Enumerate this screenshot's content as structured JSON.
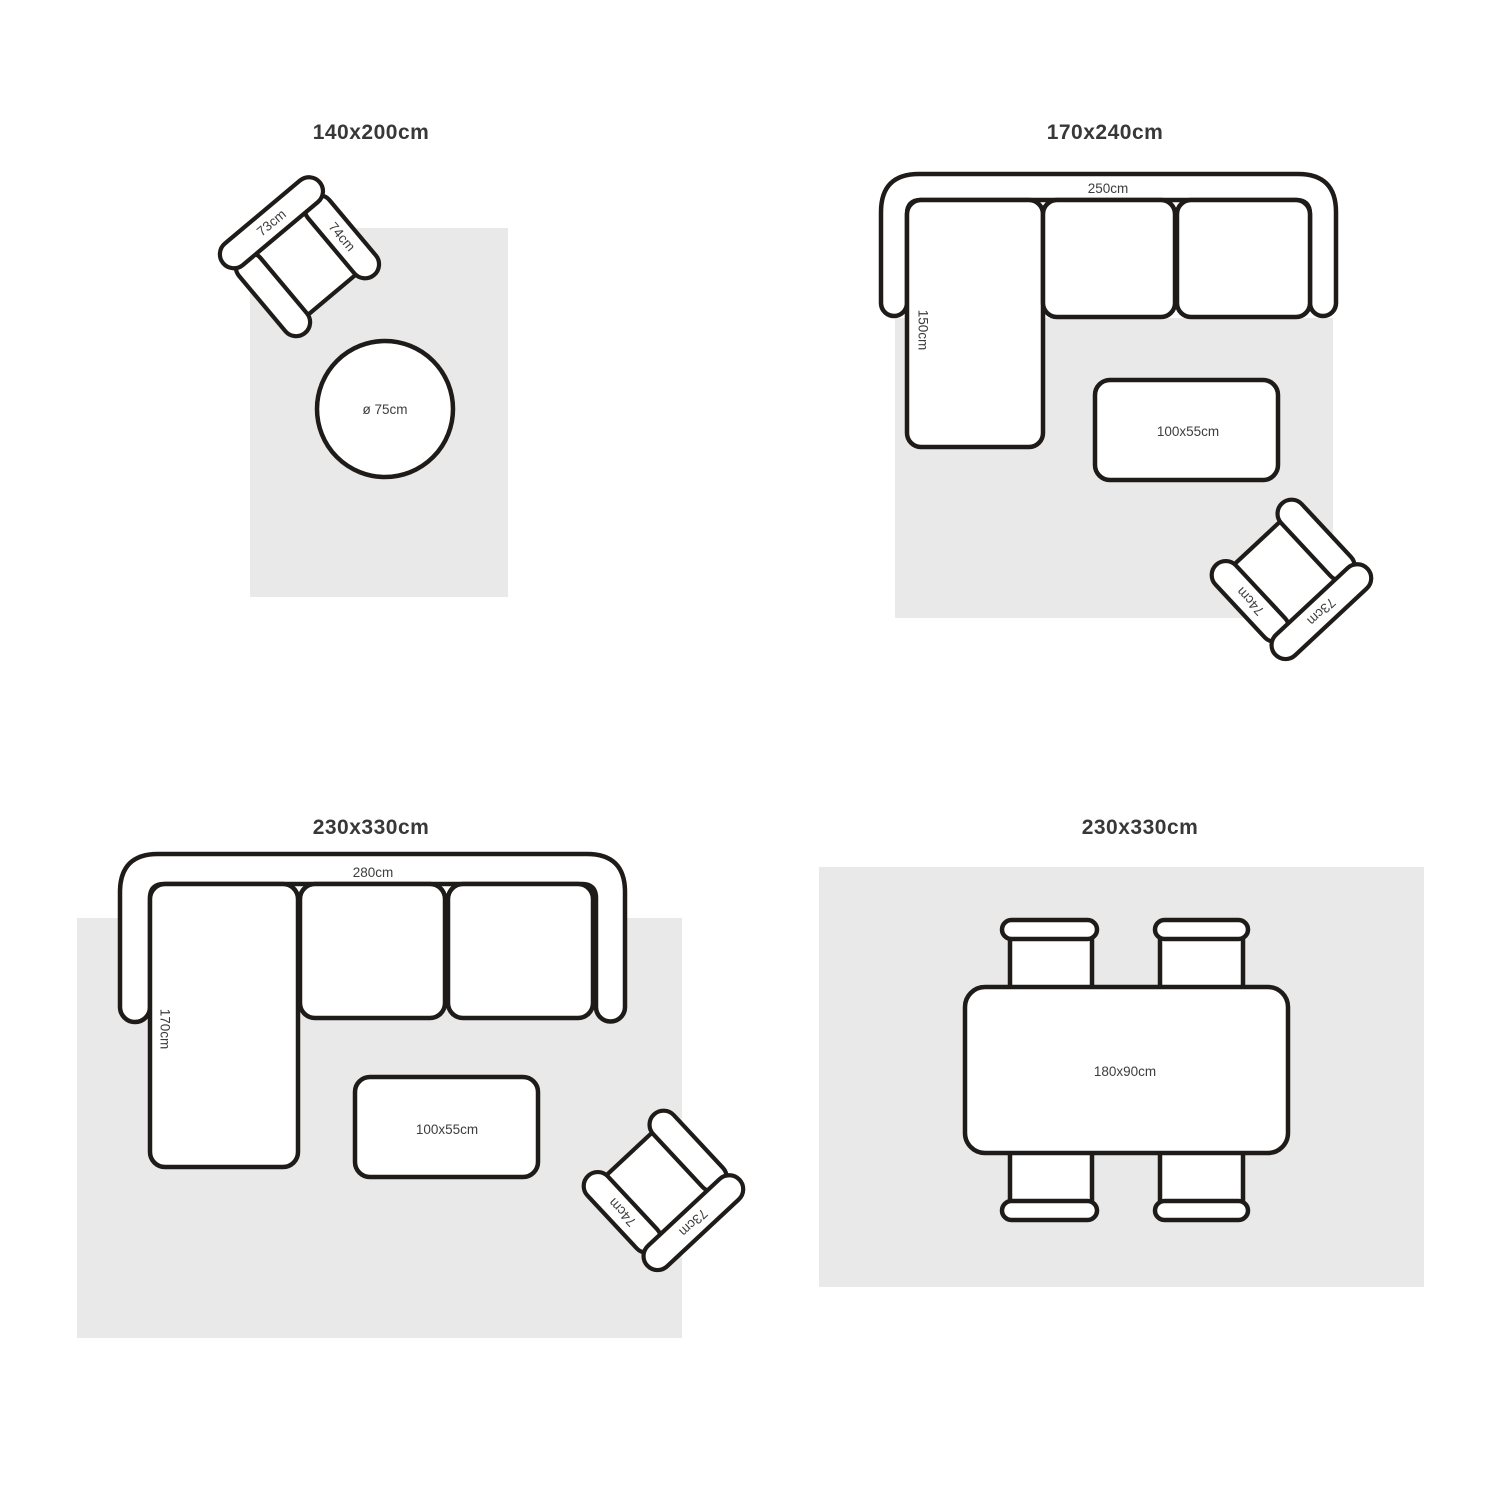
{
  "colors": {
    "outline": "#1e1b18",
    "rug_fill": "#e9e9e9",
    "label_text": "#3d3d3d",
    "title_text": "#383838"
  },
  "diagram": {
    "q1": {
      "title": "140x200cm",
      "armchair_back_label": "73cm",
      "armchair_arm_label": "74cm",
      "round_table_label": "ø 75cm"
    },
    "q2": {
      "title": "170x240cm",
      "sofa_width_label": "250cm",
      "chaise_depth_label": "150cm",
      "coffee_table_label": "100x55cm",
      "armchair_back_label": "73cm",
      "armchair_arm_label": "74cm"
    },
    "q3": {
      "title": "230x330cm",
      "sofa_width_label": "280cm",
      "chaise_depth_label": "170cm",
      "coffee_table_label": "100x55cm",
      "armchair_back_label": "73cm",
      "armchair_arm_label": "74cm"
    },
    "q4": {
      "title": "230x330cm",
      "dining_table_label": "180x90cm"
    }
  }
}
